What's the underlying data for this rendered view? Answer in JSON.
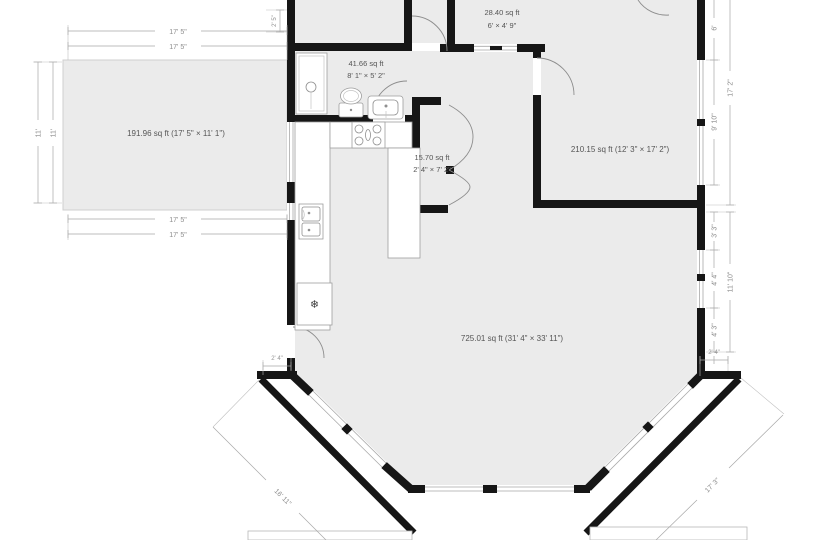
{
  "title": "Floor plan",
  "colors": {
    "wall": "#161616",
    "room_fill": "#ebebeb",
    "dimension_line": "#a8a8a8",
    "label_text": "#555555",
    "background": "#ffffff"
  },
  "icons": {
    "freezer": "❄"
  },
  "rooms": {
    "left_deck": {
      "label": "191.96 sq ft (17' 5\" × 11' 1\")"
    },
    "bathroom": {
      "area": "41.66 sq ft",
      "size": "8' 1\" × 5' 2\""
    },
    "top_closet": {
      "area": "28.40 sq ft",
      "size": "6' × 4' 9\""
    },
    "hall_closet": {
      "area": "15.70 sq ft",
      "size": "2' 4\" × 7' 2\""
    },
    "bedroom": {
      "label": "210.15 sq ft (12' 3\" × 17' 2\")"
    },
    "living": {
      "label": "725.01 sq ft (31' 4\" × 33' 11\")"
    }
  },
  "dims": {
    "left_room_top_outer": "17' 5\"",
    "left_room_top_inner": "17' 5\"",
    "left_room_left_outer": "11'",
    "left_room_left_inner": "11'",
    "left_room_bottom_inner": "17' 5\"",
    "left_room_bottom_outer": "17' 5\"",
    "top_wall_stub": "2' 5\"",
    "right_upper_a": "6'",
    "right_upper_b": "9' 10\"",
    "right_upper_total": "17' 2\"",
    "right_lower_a": "3' 3\"",
    "right_lower_b": "4' 4\"",
    "right_lower_c": "4' 3\"",
    "right_lower_total": "11' 10\"",
    "right_corner_step": "2' 4\"",
    "left_corner_step": "2' 4\"",
    "porch_left": "16' 11\"",
    "porch_right": "17' 3\""
  }
}
